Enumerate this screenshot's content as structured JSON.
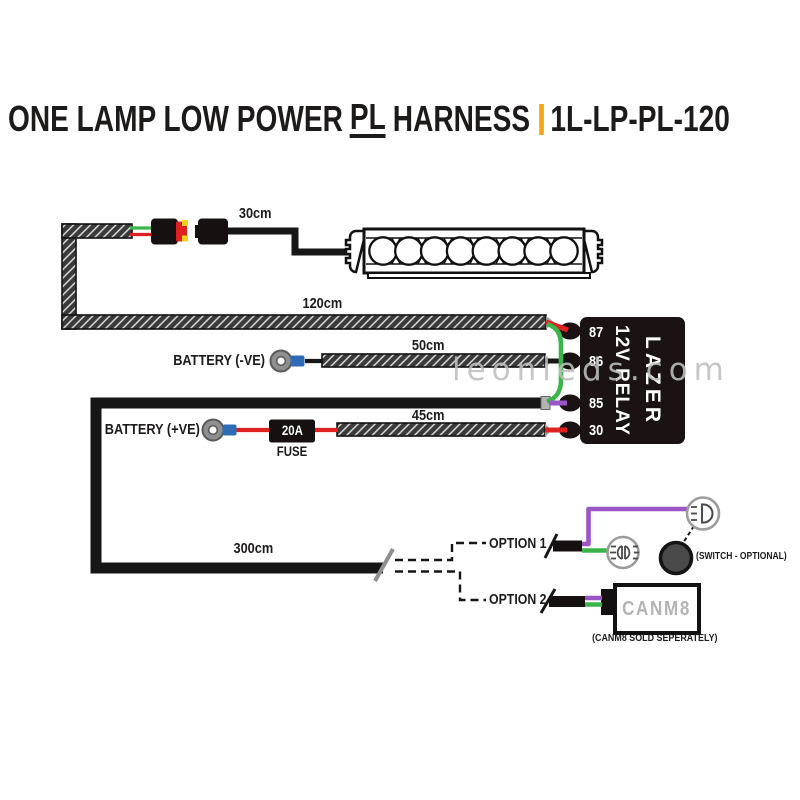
{
  "title": {
    "part1": "ONE LAMP LOW POWER",
    "part2_underlined": "PL",
    "part3": "HARNESS",
    "code": "1L-LP-PL-120"
  },
  "watermark": "leonleds.com",
  "lengths": {
    "lamp_lead": "30cm",
    "main_loom": "120cm",
    "negative_lead": "50cm",
    "positive_lead": "45cm",
    "switch_lead": "300cm"
  },
  "battery": {
    "negative": "BATTERY (-VE)",
    "positive": "BATTERY (+VE)"
  },
  "fuse": {
    "rating": "20A",
    "label": "FUSE"
  },
  "relay": {
    "brand": "LAZER",
    "type": "12V RELAY",
    "terminals": [
      "87",
      "86",
      "85",
      "30"
    ]
  },
  "options": {
    "option1": "OPTION 1",
    "option2": "OPTION 2",
    "switch_note": "(SWITCH - OPTIONAL)",
    "canm8": "CANM8",
    "canm8_note": "(CANM8 SOLD SEPERATELY)"
  },
  "colors": {
    "accent_yellow": "#F2A71B",
    "wire_red": "#E02121",
    "wire_green": "#3BB54A",
    "wire_purple": "#9C57C6",
    "terminal_blue": "#2E6CB5",
    "connector_yellow": "#F7D020",
    "switch_gray": "#4A4A4A",
    "relay_black": "#1A1213",
    "canm8_gray": "#B3B3B3",
    "watermark_gray": "#BFBFBF",
    "text_black": "#1D1A1A"
  }
}
